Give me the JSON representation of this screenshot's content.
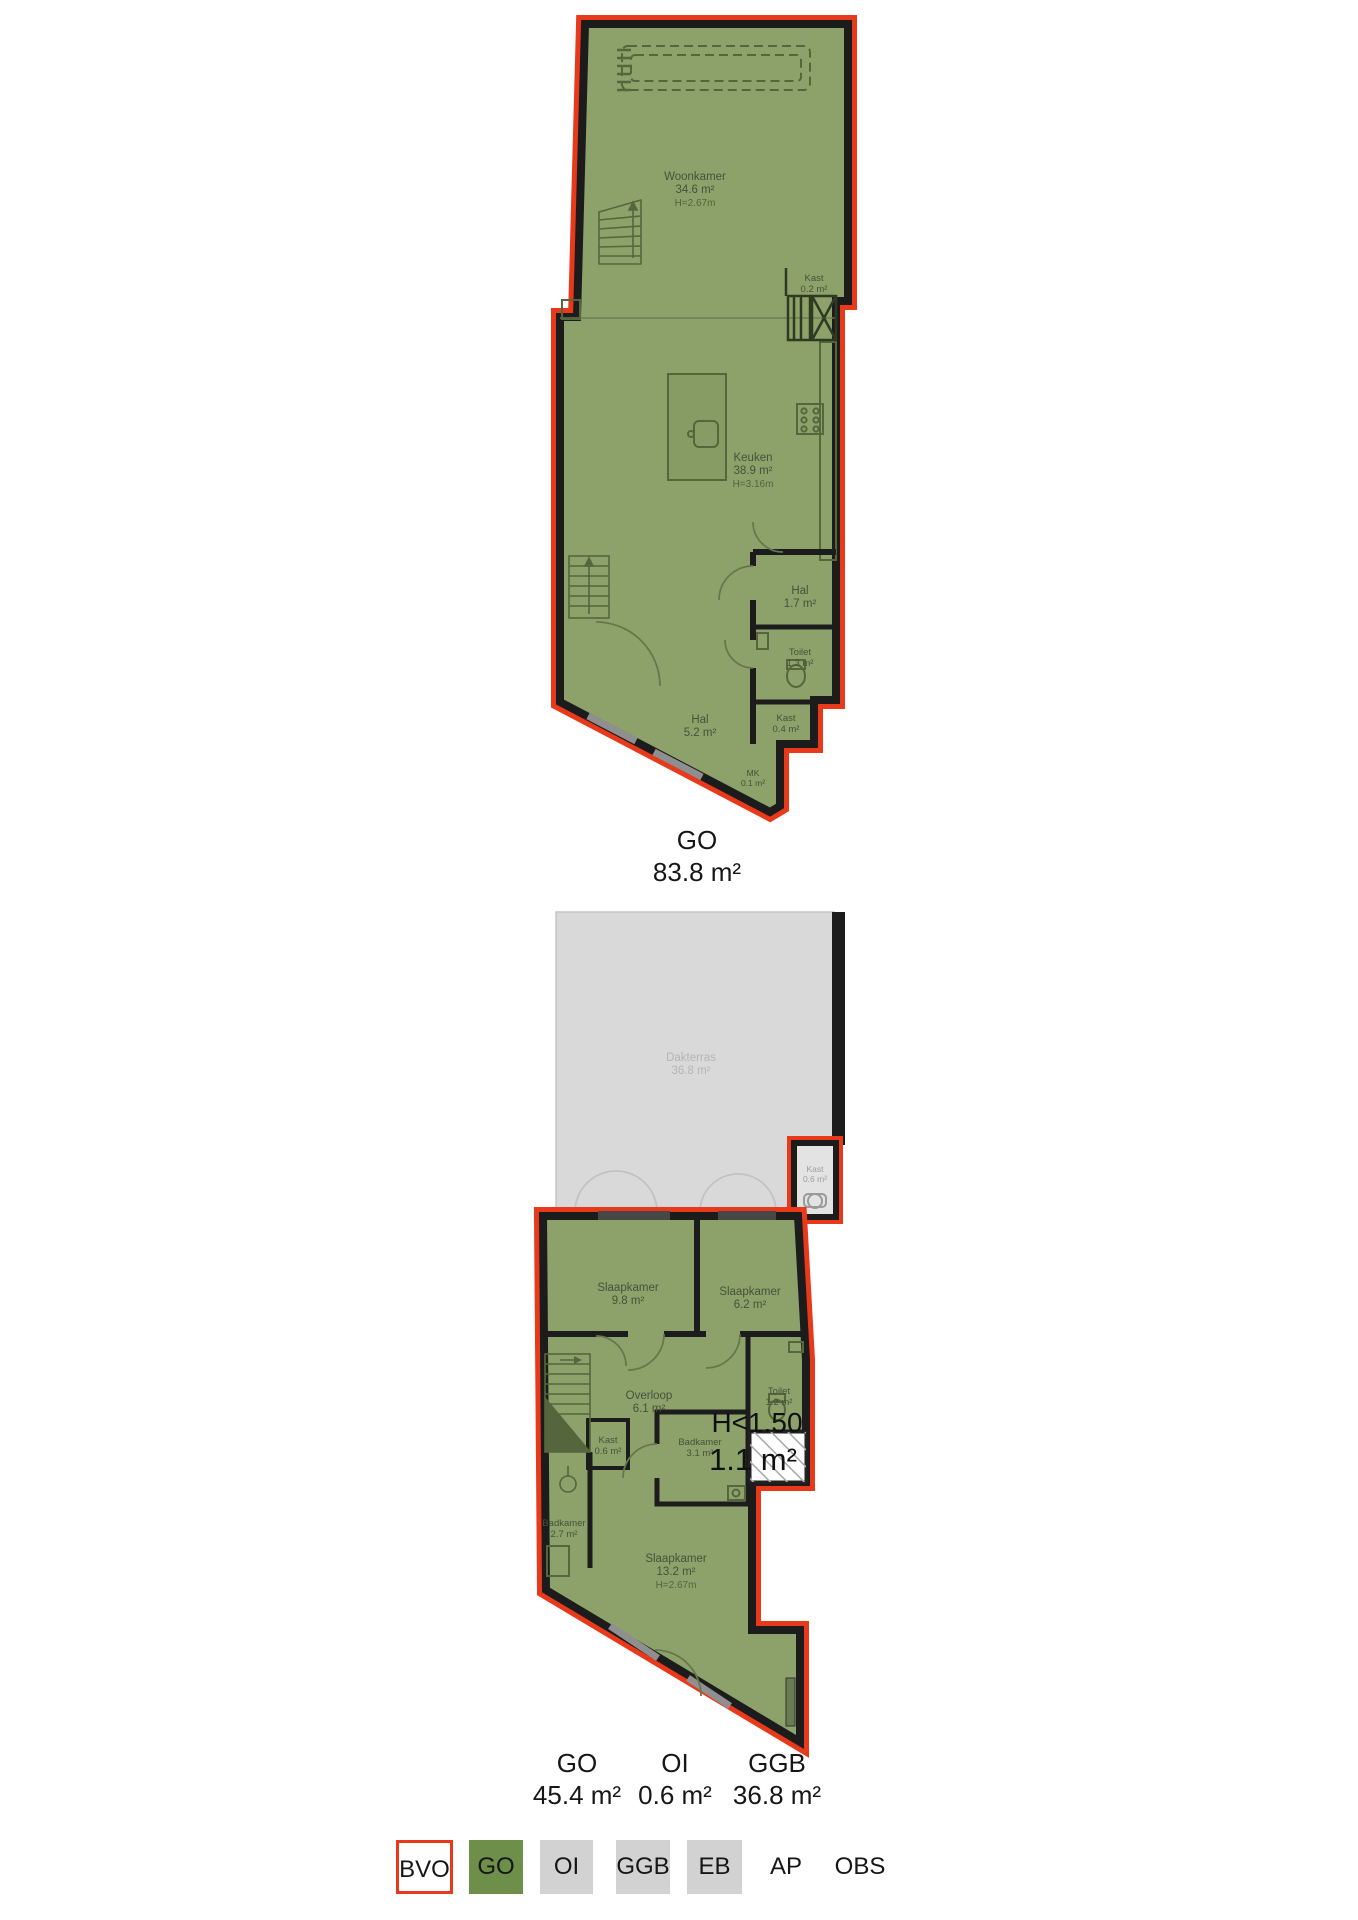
{
  "colors": {
    "bvo_outline": "#e8391a",
    "go_fill": "#8da26b",
    "go_legend": "#6d8f4a",
    "terrace_fill": "#d9d9d9",
    "legend_gray": "#d2d2d2",
    "wall_black": "#1c1c1c"
  },
  "floor1": {
    "rooms": {
      "woonkamer": {
        "name": "Woonkamer",
        "area": "34.6 m²",
        "height": "H=2.67m"
      },
      "keuken": {
        "name": "Keuken",
        "area": "38.9 m²",
        "height": "H=3.16m"
      },
      "kast_boven": {
        "name": "Kast",
        "area": "0.2 m²"
      },
      "hal_klein": {
        "name": "Hal",
        "area": "1.7 m²"
      },
      "toilet": {
        "name": "Toilet",
        "area": "1.3 m²"
      },
      "kast_onder": {
        "name": "Kast",
        "area": "0.4 m²"
      },
      "hal": {
        "name": "Hal",
        "area": "5.2 m²"
      },
      "mk": {
        "name": "MK",
        "area": "0.1 m²"
      }
    },
    "summary": {
      "code": "GO",
      "area": "83.8 m²"
    }
  },
  "floor2": {
    "rooms": {
      "dakterras": {
        "name": "Dakterras",
        "area": "36.8 m²"
      },
      "kast_oi": {
        "name": "Kast",
        "area": "0.6 m²"
      },
      "slaapkamer_1": {
        "name": "Slaapkamer",
        "area": "9.8 m²"
      },
      "slaapkamer_2": {
        "name": "Slaapkamer",
        "area": "6.2 m²"
      },
      "overloop": {
        "name": "Overloop",
        "area": "6.1 m²"
      },
      "toilet": {
        "name": "Toilet",
        "area": "1.2 m²"
      },
      "kast": {
        "name": "Kast",
        "area": "0.6 m²"
      },
      "badkamer_1": {
        "name": "Badkamer",
        "area": "3.1 m²"
      },
      "badkamer_2": {
        "name": "Badkamer",
        "area": "2.7 m²"
      },
      "slaapkamer_3": {
        "name": "Slaapkamer",
        "area": "13.2 m²",
        "height": "H=2.67m"
      }
    },
    "low_headroom": {
      "label": "H<1.50",
      "area": "1.1 m²"
    },
    "summaries": [
      {
        "code": "GO",
        "area": "45.4 m²"
      },
      {
        "code": "OI",
        "area": "0.6 m²"
      },
      {
        "code": "GGB",
        "area": "36.8 m²"
      }
    ]
  },
  "legend": {
    "items": [
      {
        "code": "BVO"
      },
      {
        "code": "GO"
      },
      {
        "code": "OI"
      },
      {
        "code": "GGB"
      },
      {
        "code": "EB"
      },
      {
        "code": "AP"
      },
      {
        "code": "OBS"
      }
    ]
  }
}
